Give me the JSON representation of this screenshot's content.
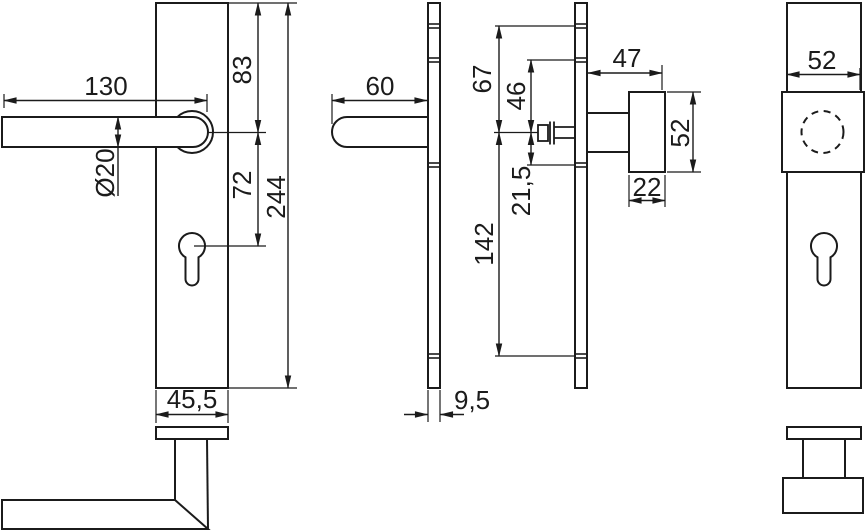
{
  "dims": {
    "front_interior": {
      "lever_length": "130",
      "top_to_lever_axis": "83",
      "lever_diameter": "Ø20",
      "axis_to_cylinder": "72",
      "plate_height": "244",
      "plate_width": "45,5"
    },
    "side_interior": {
      "lever_projection": "60",
      "plate_thickness": "9,5"
    },
    "side_exterior": {
      "top_to_knob_axis": "67",
      "upper_ref_to_axis": "46",
      "axis_to_lower_ref": "21,5",
      "axis_to_bottom_ref": "142",
      "knob_projection": "47",
      "knob_height": "52",
      "knob_depth": "22"
    },
    "front_exterior": {
      "knob_width": "52"
    }
  }
}
